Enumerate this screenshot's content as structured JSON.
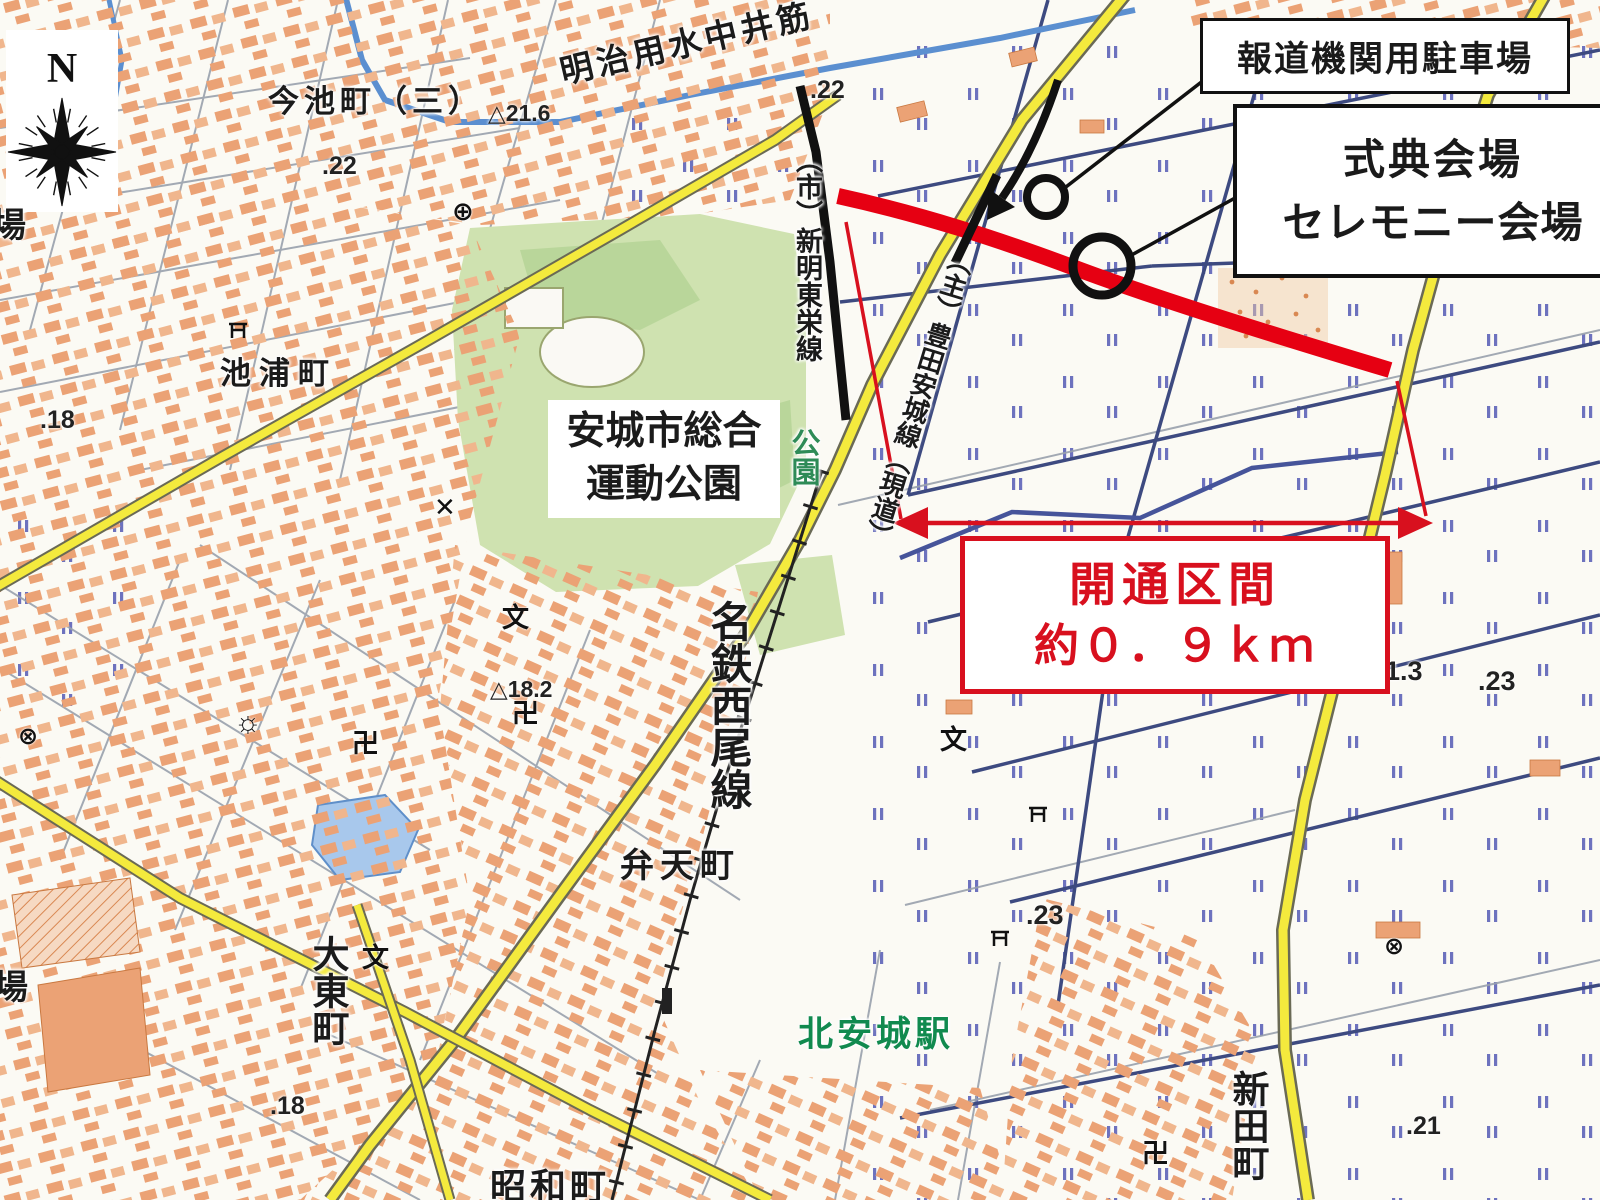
{
  "compass": {
    "north": "N"
  },
  "labels": {
    "imaike_cho": "今池町（三）",
    "meiji_canal": "明治用水中井筋",
    "ikeura_cho": "池浦町",
    "sports_park_l1": "安城市総合",
    "sports_park_l2": "運動公園",
    "shinmei_toei_line": "（市）新明東栄線",
    "toyota_anjo_line": "（主）豊田安城線（現道）",
    "meitetsu_nishio_line": "名鉄西尾線",
    "benten_cho": "弁天町",
    "daito_cho": "大東町",
    "showa_cho": "昭和町",
    "kita_anjo_station": "北安城駅",
    "shinden_cho": "新田町",
    "park": "公園",
    "partial_top_left": "場",
    "partial_bottom_left": "場"
  },
  "callouts": {
    "press_parking": "報道機関用駐車場",
    "ceremony_l1": "式典会場",
    "ceremony_l2": "セレモニー会場",
    "opening_l1": "開通区間",
    "opening_l2": "約０．９ｋｍ"
  },
  "elevations": [
    {
      "t": "△21.6"
    },
    {
      "t": ".22"
    },
    {
      "t": ".22"
    },
    {
      "t": ".18"
    },
    {
      "t": "△18.2"
    },
    {
      "t": "21.3"
    },
    {
      "t": ".23"
    },
    {
      "t": ".23"
    },
    {
      "t": ".21"
    },
    {
      "t": ".18"
    }
  ],
  "symbols": [
    {
      "g": "⊕"
    },
    {
      "g": "✕"
    },
    {
      "g": "☼"
    },
    {
      "g": "卍"
    },
    {
      "g": "卍"
    },
    {
      "g": "文"
    },
    {
      "g": "文"
    },
    {
      "g": "文"
    },
    {
      "g": "⊗"
    },
    {
      "g": "⊗"
    },
    {
      "g": "卍"
    }
  ],
  "colors": {
    "opened_road_red": "#e60012",
    "annotation_red": "#d8101e",
    "road_yellow": "#f4ea3d",
    "park_green": "#cfe2b0",
    "water_blue": "#5b8fd0",
    "urban_salmon": "#eba275",
    "station_green": "#118a4f"
  }
}
